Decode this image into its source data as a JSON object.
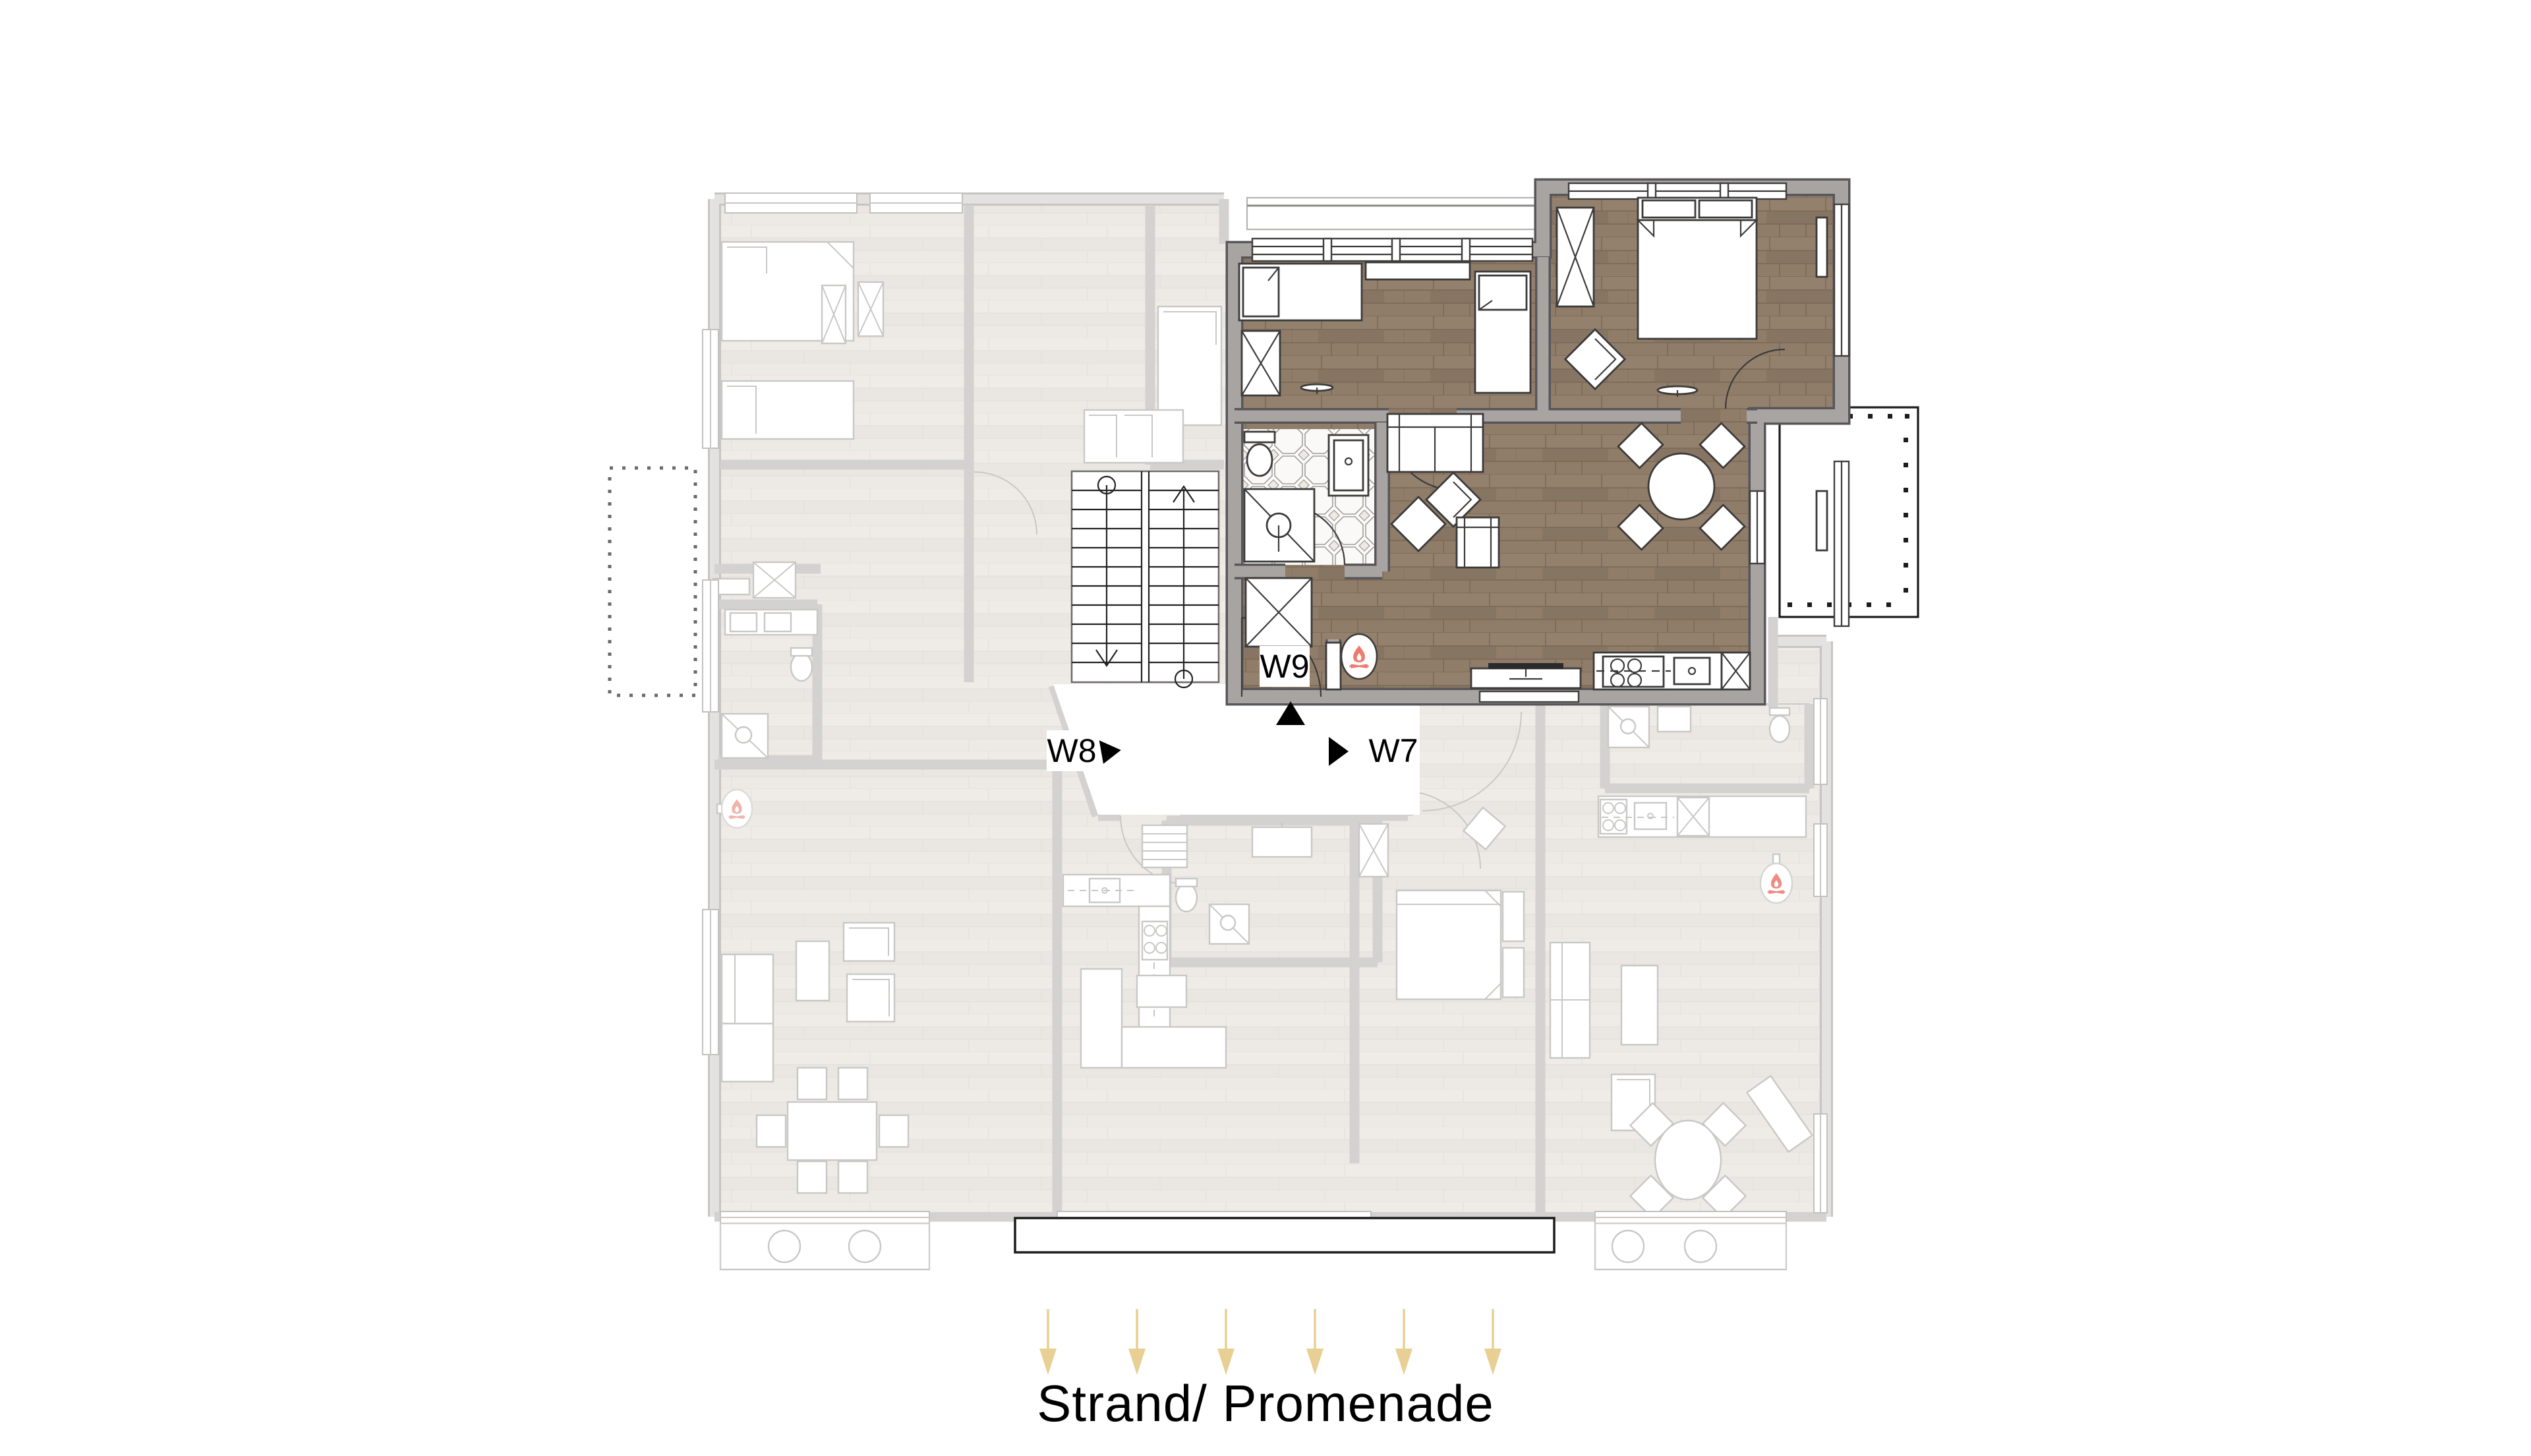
{
  "plan": {
    "type": "apartment-floorplan",
    "street": {
      "label": "Strand/ Promenade",
      "arrows": {
        "count": 6,
        "direction": "down",
        "color": "#e8d094"
      }
    },
    "units": {
      "w9": {
        "label": "W9",
        "state": "highlighted",
        "floor": "dark-wood"
      },
      "w8": {
        "label": "W8",
        "state": "inactive"
      },
      "w7": {
        "label": "W7",
        "state": "inactive"
      }
    },
    "icons": {
      "fireplace": {
        "name": "fireplace-icon",
        "count": 3,
        "flame_color": "#ee7b70"
      }
    },
    "colors": {
      "highlight_floor": "#8d7b69",
      "highlight_wall": "#a7a4a2",
      "inactive_wall": "#d3d2d0",
      "inactive_floor": "#edebe7",
      "terrace_outline": "#1c1c1c",
      "balcony_outline": "#1c1c1c",
      "street_arrow": "#e8d094"
    }
  }
}
